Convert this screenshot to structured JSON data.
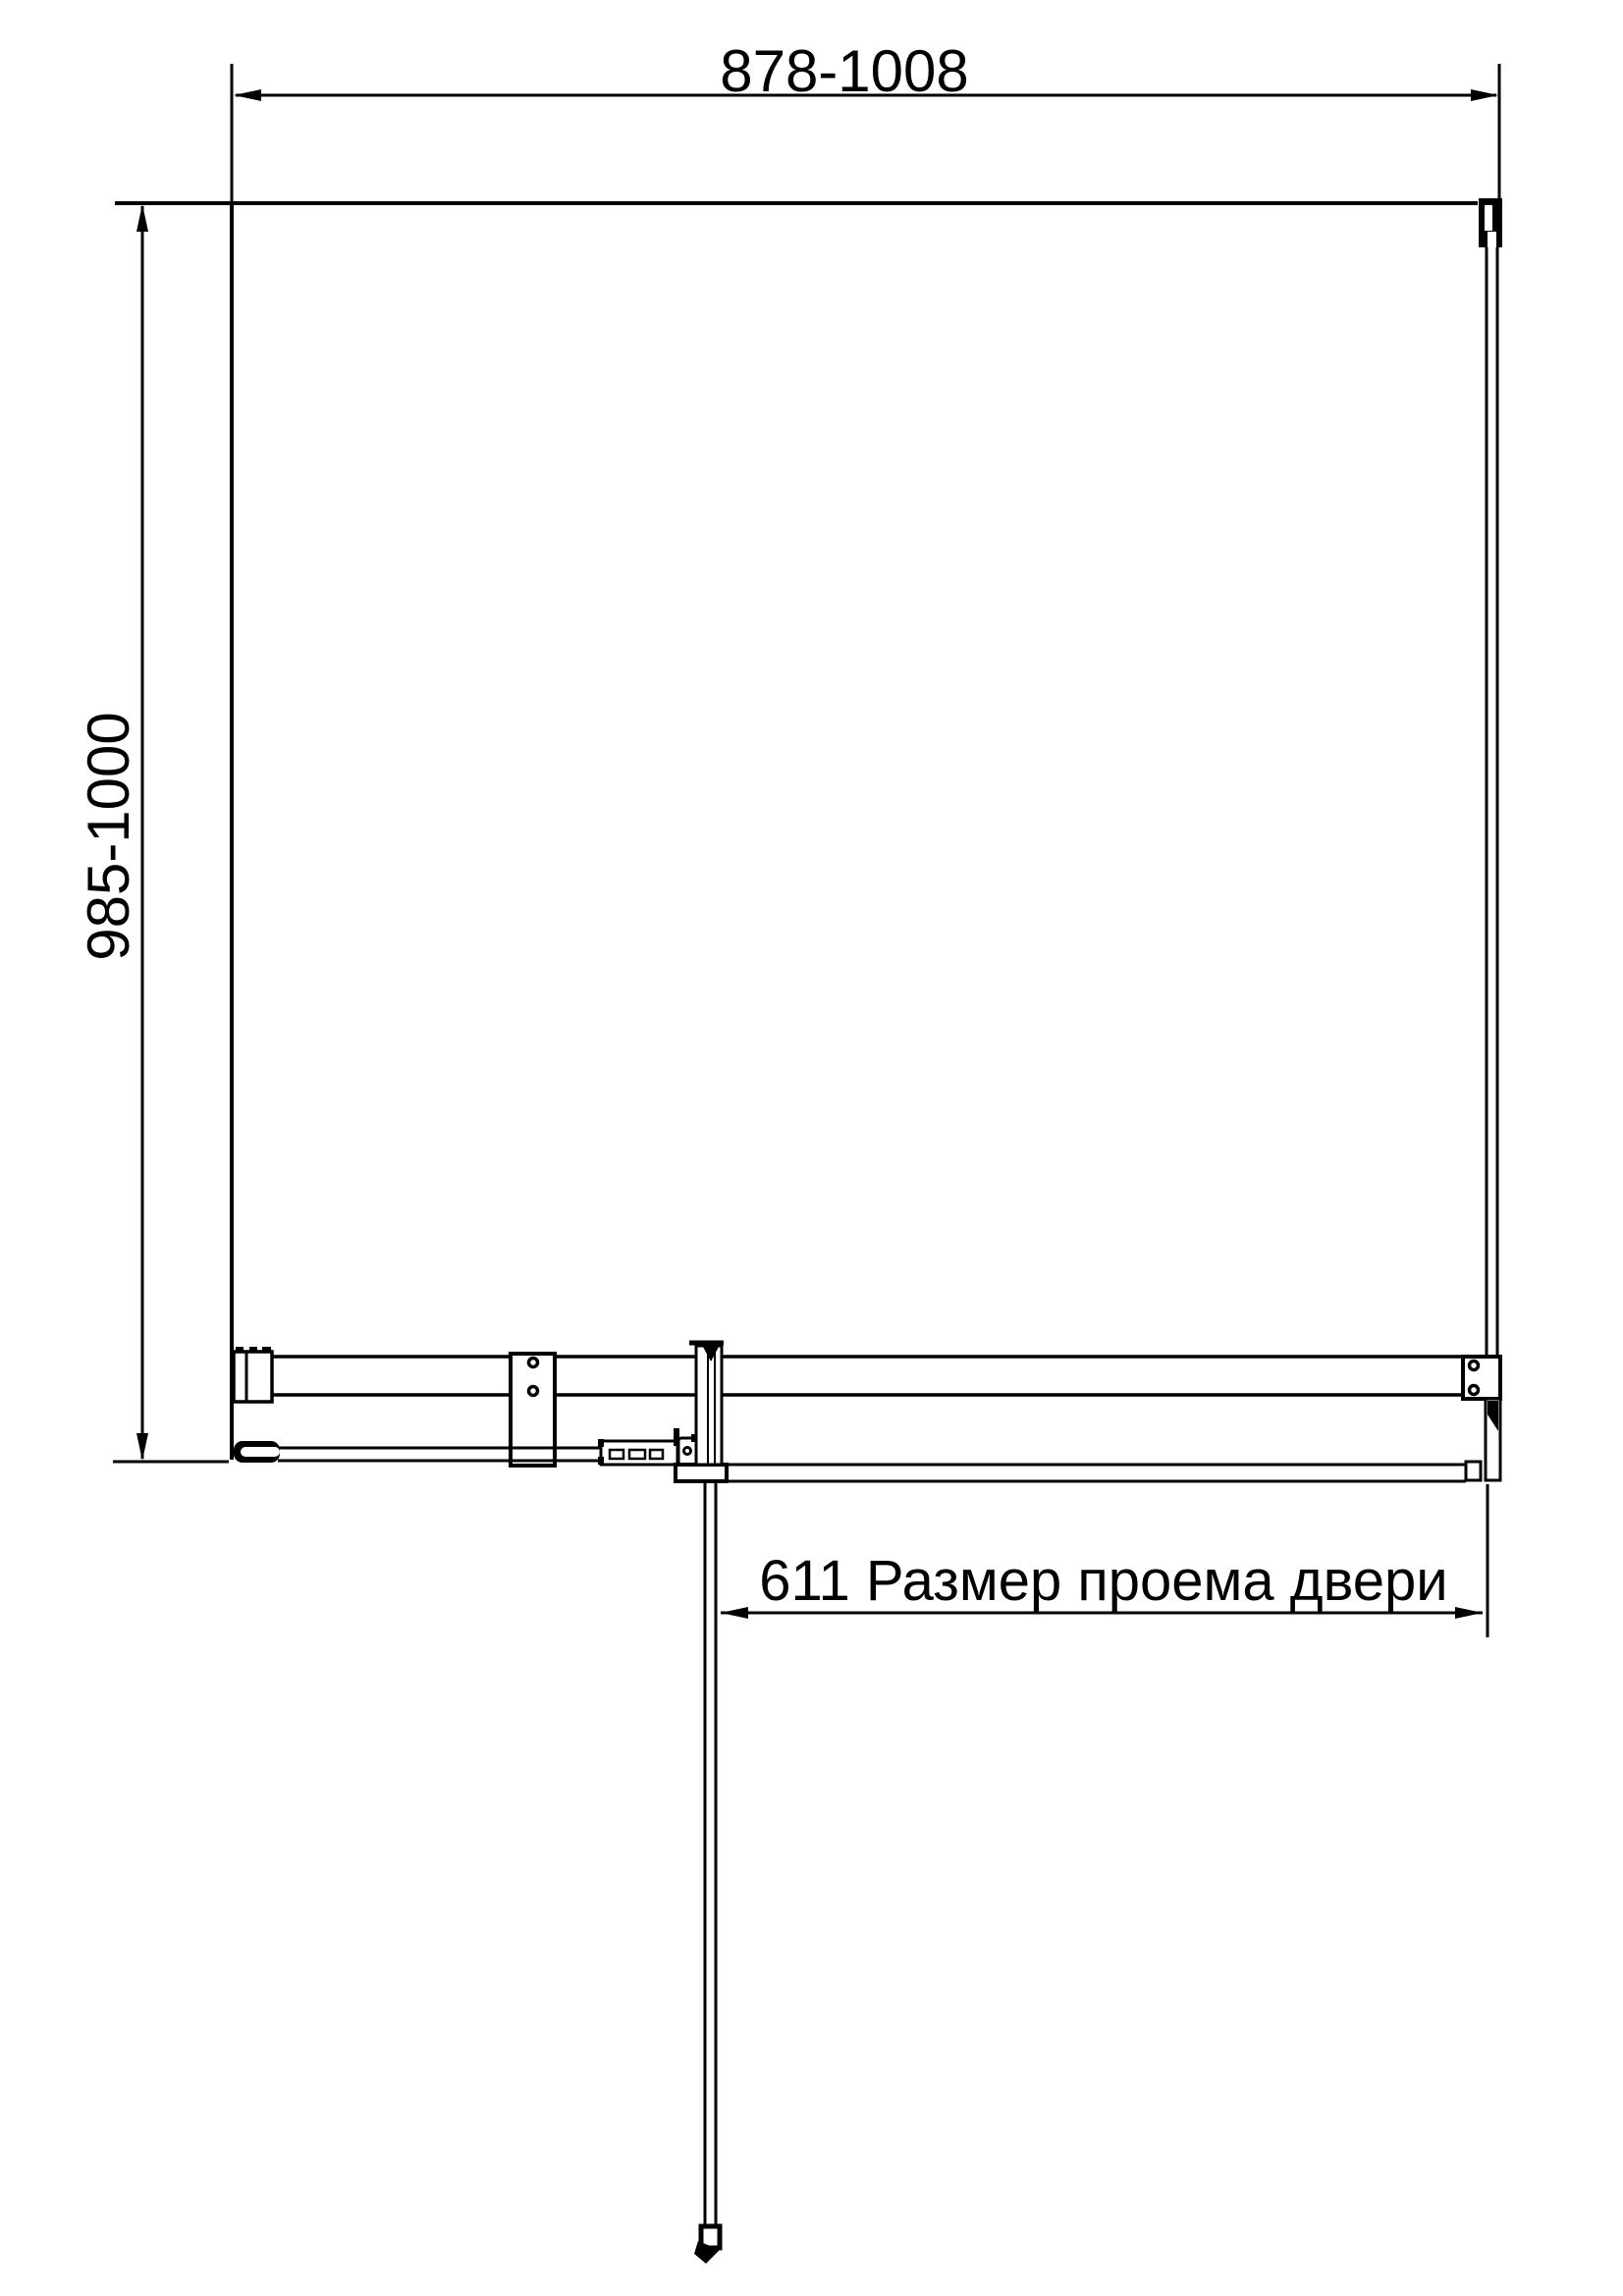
{
  "drawing": {
    "dimensions": {
      "overall_width_label": "878-1008",
      "overall_depth_label": "985-1000",
      "door_opening_label": "611 Размер проема двери"
    },
    "colors": {
      "line": "#000000",
      "background": "#ffffff"
    }
  }
}
